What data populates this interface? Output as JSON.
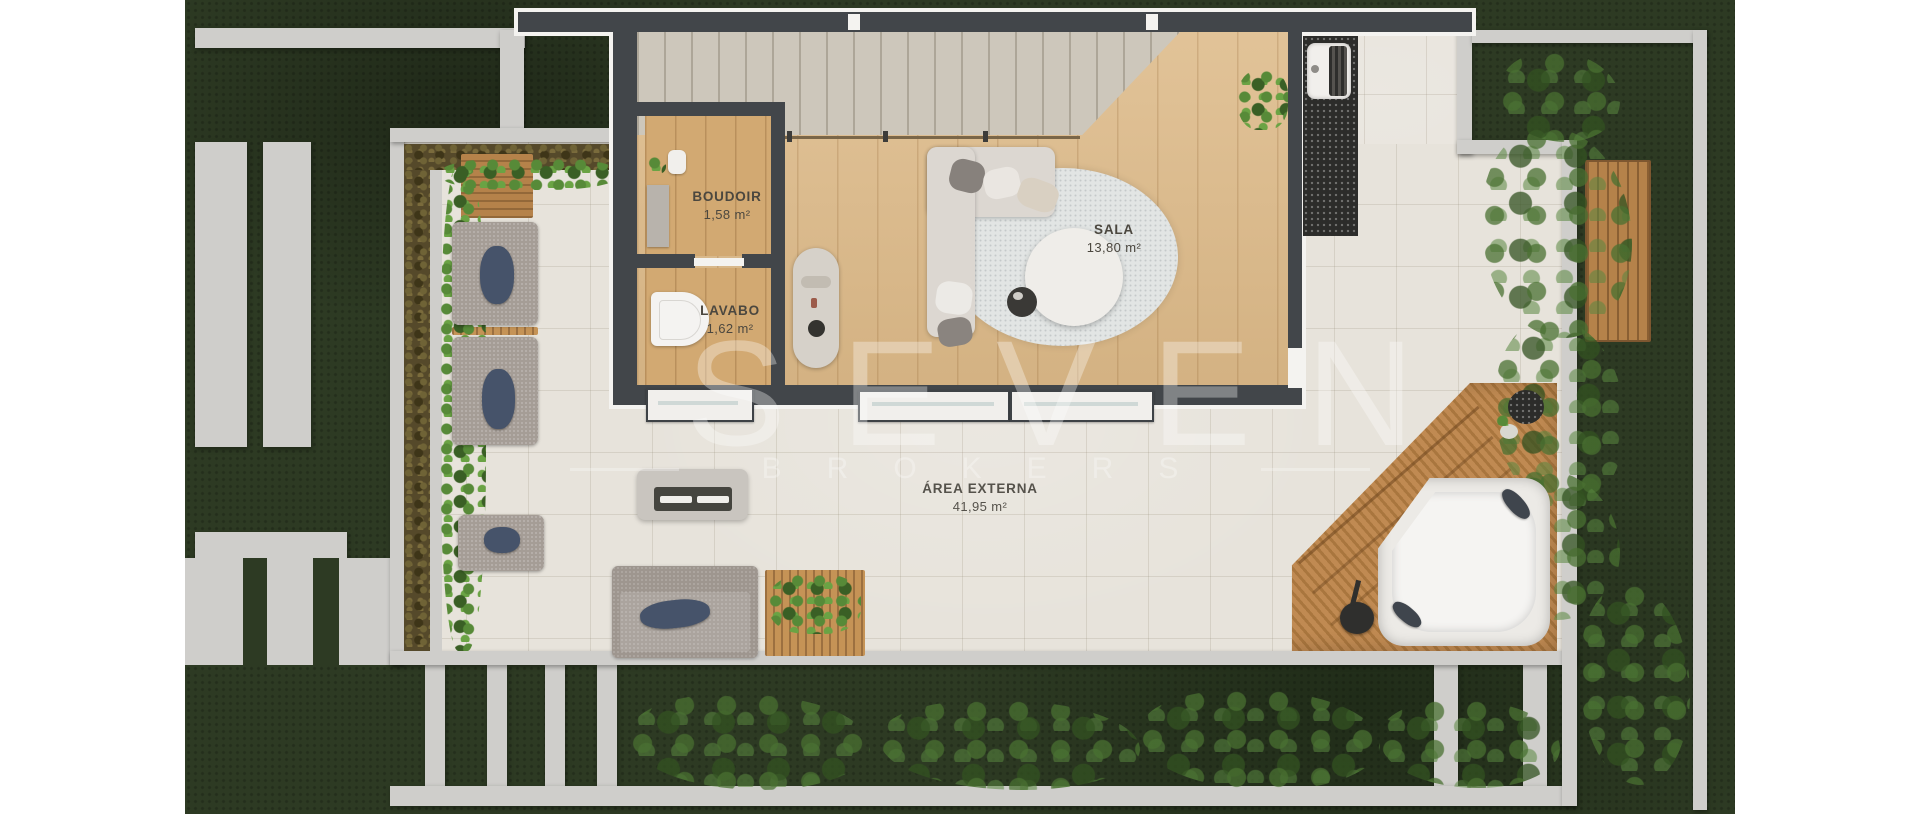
{
  "plan": {
    "type": "floorplan-render",
    "level": "terrace / pavement level",
    "rooms": [
      {
        "id": "boudoir",
        "name": "BOUDOIR",
        "area": "1,58 m²"
      },
      {
        "id": "lavabo",
        "name": "LAVABO",
        "area": "1,62 m²"
      },
      {
        "id": "sala",
        "name": "SALA",
        "area": "13,80 m²"
      },
      {
        "id": "area_externa",
        "name": "ÁREA EXTERNA",
        "area": "41,95 m²"
      }
    ]
  },
  "watermark": {
    "brand": "SEVEN",
    "subtitle": "BROKERS"
  },
  "palette": {
    "lawn": "#2d3a23",
    "terrace_tile": "#e7e3db",
    "wood_floor": "#debc8c",
    "deck_wood": "#b5824a",
    "wall_light": "#cfcecb",
    "wall_dark": "#42464a",
    "foliage_bright": "#578a38",
    "label_text": "#4b473f",
    "watermark": "rgba(255,255,255,0.33)"
  }
}
